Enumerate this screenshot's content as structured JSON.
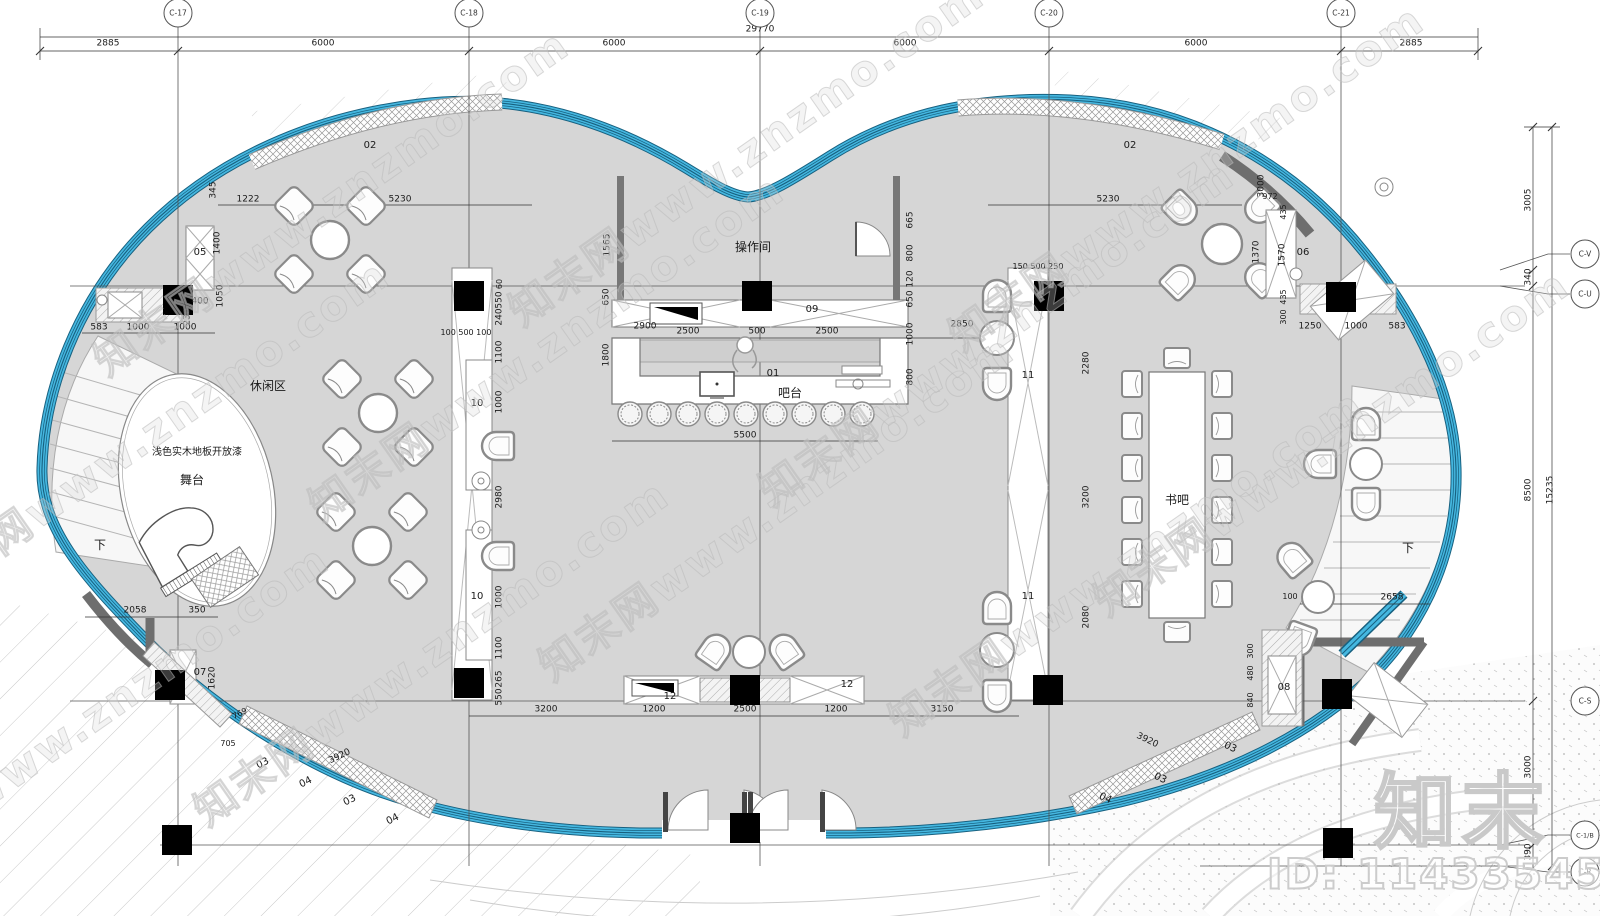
{
  "meta": {
    "drawing_type": "平面布置图",
    "floor_fill": "#d6d6d6",
    "band_blue": "#45b7e0",
    "band_dark": "#17607f",
    "wall_gray": "#6e6e6e"
  },
  "watermark": {
    "tile_text": "知末网www.znzmo.com",
    "tiles": [
      {
        "x": 150,
        "y": 430
      },
      {
        "x": 330,
        "y": 200
      },
      {
        "x": 545,
        "y": 345
      },
      {
        "x": 745,
        "y": 150
      },
      {
        "x": 775,
        "y": 505
      },
      {
        "x": 995,
        "y": 330
      },
      {
        "x": 1185,
        "y": 175
      },
      {
        "x": 1125,
        "y": 560
      },
      {
        "x": 430,
        "y": 650
      },
      {
        "x": 90,
        "y": 715
      },
      {
        "x": 1330,
        "y": 440
      }
    ],
    "logo_text": "知末",
    "id_text": "ID: 1143354520"
  },
  "grid": {
    "top": [
      {
        "label": "C-17",
        "x": 178
      },
      {
        "label": "C-18",
        "x": 469
      },
      {
        "label": "C-19",
        "x": 760
      },
      {
        "label": "C-20",
        "x": 1049
      },
      {
        "label": "C-21",
        "x": 1341
      }
    ],
    "right": [
      {
        "label": "C-V",
        "x": 1585,
        "y": 254
      },
      {
        "label": "C-U",
        "x": 1585,
        "y": 294
      },
      {
        "label": "C-S",
        "x": 1585,
        "y": 701
      },
      {
        "label": "C-1/B",
        "x": 1585,
        "y": 835
      },
      {
        "label": "C-R",
        "x": 1585,
        "y": 872
      }
    ]
  },
  "annotations": [
    {
      "text": "29770",
      "x": 760,
      "y": 30,
      "name": "dim-total-width"
    },
    {
      "text": "2885",
      "x": 108,
      "y": 44
    },
    {
      "text": "6000",
      "x": 323,
      "y": 44
    },
    {
      "text": "6000",
      "x": 614,
      "y": 44
    },
    {
      "text": "6000",
      "x": 905,
      "y": 44
    },
    {
      "text": "6000",
      "x": 1196,
      "y": 44
    },
    {
      "text": "2885",
      "x": 1411,
      "y": 44
    },
    {
      "text": "3005",
      "x": 1529,
      "y": 200,
      "rot": -90
    },
    {
      "text": "340",
      "x": 1529,
      "y": 277,
      "rot": -90
    },
    {
      "text": "8500",
      "x": 1529,
      "y": 490,
      "rot": -90
    },
    {
      "text": "15235",
      "x": 1551,
      "y": 490,
      "rot": -90,
      "name": "dim-total-height"
    },
    {
      "text": "3000",
      "x": 1529,
      "y": 767,
      "rot": -90
    },
    {
      "text": "390",
      "x": 1529,
      "y": 852,
      "rot": -90
    },
    {
      "text": "操作间",
      "x": 753,
      "y": 247,
      "cls": "room",
      "name": "room-label-operation"
    },
    {
      "text": "吧台",
      "x": 790,
      "y": 393,
      "cls": "room",
      "name": "room-label-bar"
    },
    {
      "text": "书吧",
      "x": 1177,
      "y": 500,
      "cls": "room",
      "name": "room-label-book-bar"
    },
    {
      "text": "休闲区",
      "x": 268,
      "y": 386,
      "cls": "room",
      "name": "room-label-leisure"
    },
    {
      "text": "浅色实木地板开放漆",
      "x": 197,
      "y": 453,
      "cls": "num",
      "name": "finish-note"
    },
    {
      "text": "舞台",
      "x": 192,
      "y": 480,
      "cls": "room",
      "name": "room-label-stage"
    },
    {
      "text": "下",
      "x": 100,
      "y": 545,
      "cls": "room",
      "name": "stair-down-left"
    },
    {
      "text": "下",
      "x": 1408,
      "y": 548,
      "cls": "room",
      "name": "stair-down-right"
    },
    {
      "text": "01",
      "x": 773,
      "y": 374,
      "cls": "num"
    },
    {
      "text": "09",
      "x": 812,
      "y": 310,
      "cls": "num"
    },
    {
      "text": "02",
      "x": 370,
      "y": 146,
      "cls": "num"
    },
    {
      "text": "02",
      "x": 1130,
      "y": 146,
      "cls": "num"
    },
    {
      "text": "05",
      "x": 200,
      "y": 253,
      "cls": "num"
    },
    {
      "text": "06",
      "x": 1303,
      "y": 253,
      "cls": "num"
    },
    {
      "text": "07",
      "x": 200,
      "y": 673,
      "cls": "num"
    },
    {
      "text": "08",
      "x": 1284,
      "y": 688,
      "cls": "num"
    },
    {
      "text": "10",
      "x": 477,
      "y": 404,
      "cls": "num"
    },
    {
      "text": "10",
      "x": 477,
      "y": 597,
      "cls": "num"
    },
    {
      "text": "11",
      "x": 1028,
      "y": 376,
      "cls": "num"
    },
    {
      "text": "11",
      "x": 1028,
      "y": 597,
      "cls": "num"
    },
    {
      "text": "12",
      "x": 670,
      "y": 697,
      "cls": "num"
    },
    {
      "text": "12",
      "x": 847,
      "y": 685,
      "cls": "num"
    },
    {
      "text": "03",
      "x": 263,
      "y": 764,
      "cls": "num",
      "rot": -26
    },
    {
      "text": "04",
      "x": 306,
      "y": 783,
      "cls": "num",
      "rot": -26
    },
    {
      "text": "03",
      "x": 350,
      "y": 801,
      "cls": "num",
      "rot": -26
    },
    {
      "text": "04",
      "x": 393,
      "y": 820,
      "cls": "num",
      "rot": -26
    },
    {
      "text": "04",
      "x": 1105,
      "y": 799,
      "cls": "num",
      "rot": 26
    },
    {
      "text": "03",
      "x": 1160,
      "y": 779,
      "cls": "num",
      "rot": 26
    },
    {
      "text": "03",
      "x": 1230,
      "y": 748,
      "cls": "num",
      "rot": 26
    },
    {
      "text": "345",
      "x": 214,
      "y": 190,
      "rot": -90
    },
    {
      "text": "1222",
      "x": 248,
      "y": 200
    },
    {
      "text": "5230",
      "x": 400,
      "y": 200
    },
    {
      "text": "5230",
      "x": 1108,
      "y": 200
    },
    {
      "text": "1400",
      "x": 218,
      "y": 243,
      "rot": -90
    },
    {
      "text": "1050",
      "x": 221,
      "y": 296,
      "rot": -90
    },
    {
      "text": "400",
      "x": 200,
      "y": 302
    },
    {
      "text": "230",
      "x": 188,
      "y": 317,
      "rot": -90
    },
    {
      "text": "583",
      "x": 99,
      "y": 328
    },
    {
      "text": "1000",
      "x": 138,
      "y": 328
    },
    {
      "text": "1000",
      "x": 185,
      "y": 328
    },
    {
      "text": "1565",
      "x": 608,
      "y": 245,
      "rot": -90
    },
    {
      "text": "650",
      "x": 607,
      "y": 297,
      "rot": -90
    },
    {
      "text": "1800",
      "x": 607,
      "y": 355,
      "rot": -90
    },
    {
      "text": "2900",
      "x": 645,
      "y": 327
    },
    {
      "text": "2500",
      "x": 688,
      "y": 332
    },
    {
      "text": "500",
      "x": 757,
      "y": 332
    },
    {
      "text": "2500",
      "x": 827,
      "y": 332
    },
    {
      "text": "2850",
      "x": 962,
      "y": 325
    },
    {
      "text": "5500",
      "x": 745,
      "y": 436
    },
    {
      "text": "665",
      "x": 911,
      "y": 220,
      "rot": -90
    },
    {
      "text": "800",
      "x": 911,
      "y": 253,
      "rot": -90
    },
    {
      "text": "120",
      "x": 911,
      "y": 279,
      "rot": -90
    },
    {
      "text": "650",
      "x": 911,
      "y": 299,
      "rot": -90
    },
    {
      "text": "1000",
      "x": 911,
      "y": 334,
      "rot": -90
    },
    {
      "text": "800",
      "x": 911,
      "y": 377,
      "rot": -90
    },
    {
      "text": "60",
      "x": 500,
      "y": 284,
      "rot": -90,
      "cls": "small"
    },
    {
      "text": "550",
      "x": 500,
      "y": 300,
      "rot": -90
    },
    {
      "text": "240",
      "x": 500,
      "y": 317,
      "rot": -90
    },
    {
      "text": "1100",
      "x": 500,
      "y": 352,
      "rot": -90
    },
    {
      "text": "1000",
      "x": 500,
      "y": 402,
      "rot": -90
    },
    {
      "text": "2980",
      "x": 500,
      "y": 497,
      "rot": -90
    },
    {
      "text": "1000",
      "x": 500,
      "y": 597,
      "rot": -90
    },
    {
      "text": "1100",
      "x": 500,
      "y": 648,
      "rot": -90
    },
    {
      "text": "265",
      "x": 500,
      "y": 679,
      "rot": -90
    },
    {
      "text": "550",
      "x": 500,
      "y": 697,
      "rot": -90
    },
    {
      "text": "100 500 100",
      "x": 466,
      "y": 333,
      "cls": "small"
    },
    {
      "text": "150 500 250",
      "x": 1038,
      "y": 267,
      "cls": "small"
    },
    {
      "text": "2280",
      "x": 1087,
      "y": 363,
      "rot": -90
    },
    {
      "text": "3200",
      "x": 1087,
      "y": 497,
      "rot": -90
    },
    {
      "text": "2080",
      "x": 1087,
      "y": 617,
      "rot": -90
    },
    {
      "text": "1250",
      "x": 1310,
      "y": 327
    },
    {
      "text": "1000",
      "x": 1356,
      "y": 327
    },
    {
      "text": "583",
      "x": 1397,
      "y": 327
    },
    {
      "text": "1370",
      "x": 1257,
      "y": 252,
      "rot": -90
    },
    {
      "text": "1570",
      "x": 1283,
      "y": 255,
      "rot": -90
    },
    {
      "text": "3000",
      "x": 1262,
      "y": 186,
      "rot": -90
    },
    {
      "text": "972",
      "x": 1270,
      "y": 197,
      "cls": "small"
    },
    {
      "text": "435",
      "x": 1284,
      "y": 212,
      "rot": -90,
      "cls": "small"
    },
    {
      "text": "435",
      "x": 1284,
      "y": 297,
      "rot": -90,
      "cls": "small"
    },
    {
      "text": "300",
      "x": 1284,
      "y": 317,
      "rot": -90,
      "cls": "small"
    },
    {
      "text": "2058",
      "x": 135,
      "y": 611
    },
    {
      "text": "350",
      "x": 197,
      "y": 611
    },
    {
      "text": "1620",
      "x": 213,
      "y": 678,
      "rot": -90
    },
    {
      "text": "705",
      "x": 228,
      "y": 744,
      "cls": "small"
    },
    {
      "text": "769",
      "x": 240,
      "y": 714,
      "rot": -26,
      "cls": "small"
    },
    {
      "text": "3920",
      "x": 340,
      "y": 757,
      "rot": -26
    },
    {
      "text": "3920",
      "x": 1147,
      "y": 741,
      "rot": 26
    },
    {
      "text": "3200",
      "x": 546,
      "y": 710
    },
    {
      "text": "1200",
      "x": 654,
      "y": 710
    },
    {
      "text": "2500",
      "x": 745,
      "y": 710
    },
    {
      "text": "1200",
      "x": 836,
      "y": 710
    },
    {
      "text": "3150",
      "x": 942,
      "y": 710
    },
    {
      "text": "2658",
      "x": 1392,
      "y": 598
    },
    {
      "text": "100",
      "x": 1290,
      "y": 597,
      "cls": "small"
    },
    {
      "text": "300",
      "x": 1251,
      "y": 651,
      "rot": -90,
      "cls": "small"
    },
    {
      "text": "480",
      "x": 1251,
      "y": 673,
      "rot": -90,
      "cls": "small"
    },
    {
      "text": "840",
      "x": 1251,
      "y": 700,
      "rot": -90,
      "cls": "small"
    }
  ]
}
